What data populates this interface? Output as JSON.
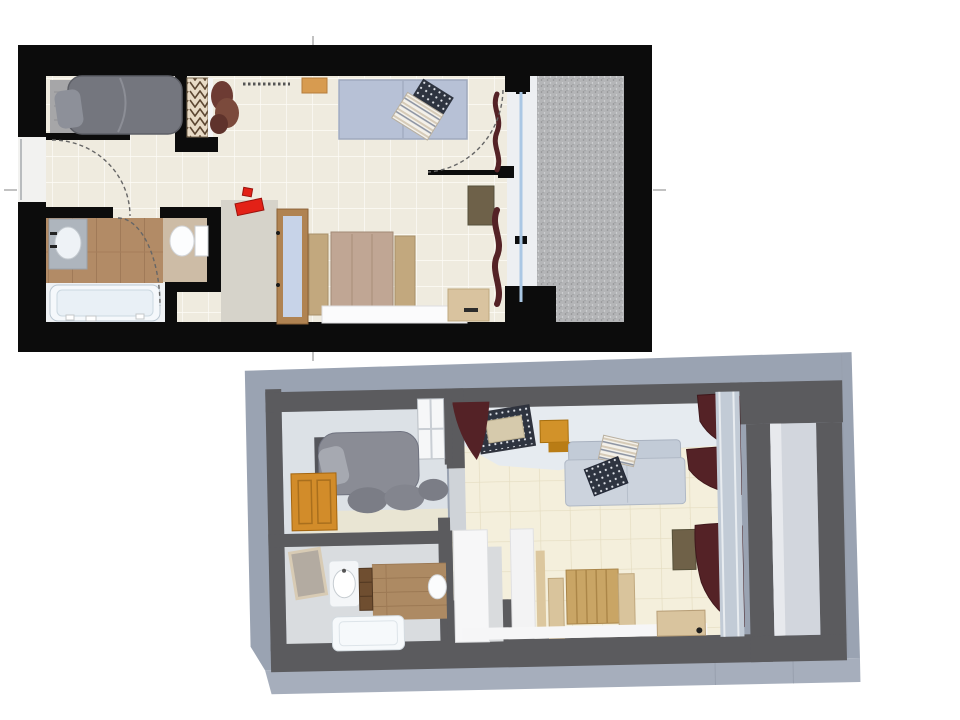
{
  "title": "studio-apartment-floorplan",
  "views": {
    "plan2d": {
      "name": "2D floor plan (top view)",
      "rooms": [
        {
          "name": "sleeping niche",
          "items": [
            "single bed",
            "bedside rug",
            "open wardrobe with hangers",
            "plant"
          ]
        },
        {
          "name": "living room",
          "items": [
            "wall shelf",
            "vent strip",
            "sofa",
            "wicker chair",
            "double bed with side panels",
            "white ledge",
            "desk",
            "side table",
            "curtains",
            "balcony door with swing arc"
          ]
        },
        {
          "name": "bathroom",
          "items": [
            "washbasin counter",
            "toilet",
            "bathtub",
            "door swing arc"
          ]
        },
        {
          "name": "entry hall",
          "items": [
            "glazed interior door",
            "red wall sign",
            "entry door swing arc"
          ]
        },
        {
          "name": "balcony",
          "items": [
            "speckled concrete floor",
            "glass window front"
          ]
        }
      ]
    },
    "view3d": {
      "name": "3D cutaway perspective view",
      "rooms": [
        {
          "name": "sleeping niche",
          "items": [
            "single bed with pillows",
            "wicker headboard",
            "wooden entry door",
            "interior window"
          ]
        },
        {
          "name": "living room",
          "items": [
            "woven ceiling lamp",
            "orange wall cabinet",
            "sofa with striped and checkered pillows",
            "white wardrobe",
            "wooden double bed",
            "desk",
            "olive wall cabinet",
            "curtains"
          ]
        },
        {
          "name": "bathroom",
          "items": [
            "framed mirror",
            "washbasin",
            "wooden bath cabinet",
            "bathtub",
            "toilet",
            "plank floor"
          ]
        },
        {
          "name": "balcony",
          "items": [
            "concrete base slab",
            "gray parapet walls",
            "light floor strip"
          ]
        }
      ]
    }
  },
  "colors": {
    "wall_black": "#0c0c0c",
    "wall_gray_3d": "#5b5b5e",
    "slab_gray": "#9aa3b2",
    "floor_cream": "#efebdf",
    "wood_floor": "#b28b66",
    "balcony_gray": "#b4b5b7",
    "sofa_blue": "#b7c1d6",
    "bed_gray": "#74767e",
    "curtain_maroon": "#542226",
    "accent_red": "#e32117",
    "door_brown": "#b08352",
    "shelf_orange": "#d79b50",
    "door_orange_3d": "#d28c2a",
    "bed_wood_3d": "#c9a565",
    "window_blue": "#aac7e4"
  }
}
